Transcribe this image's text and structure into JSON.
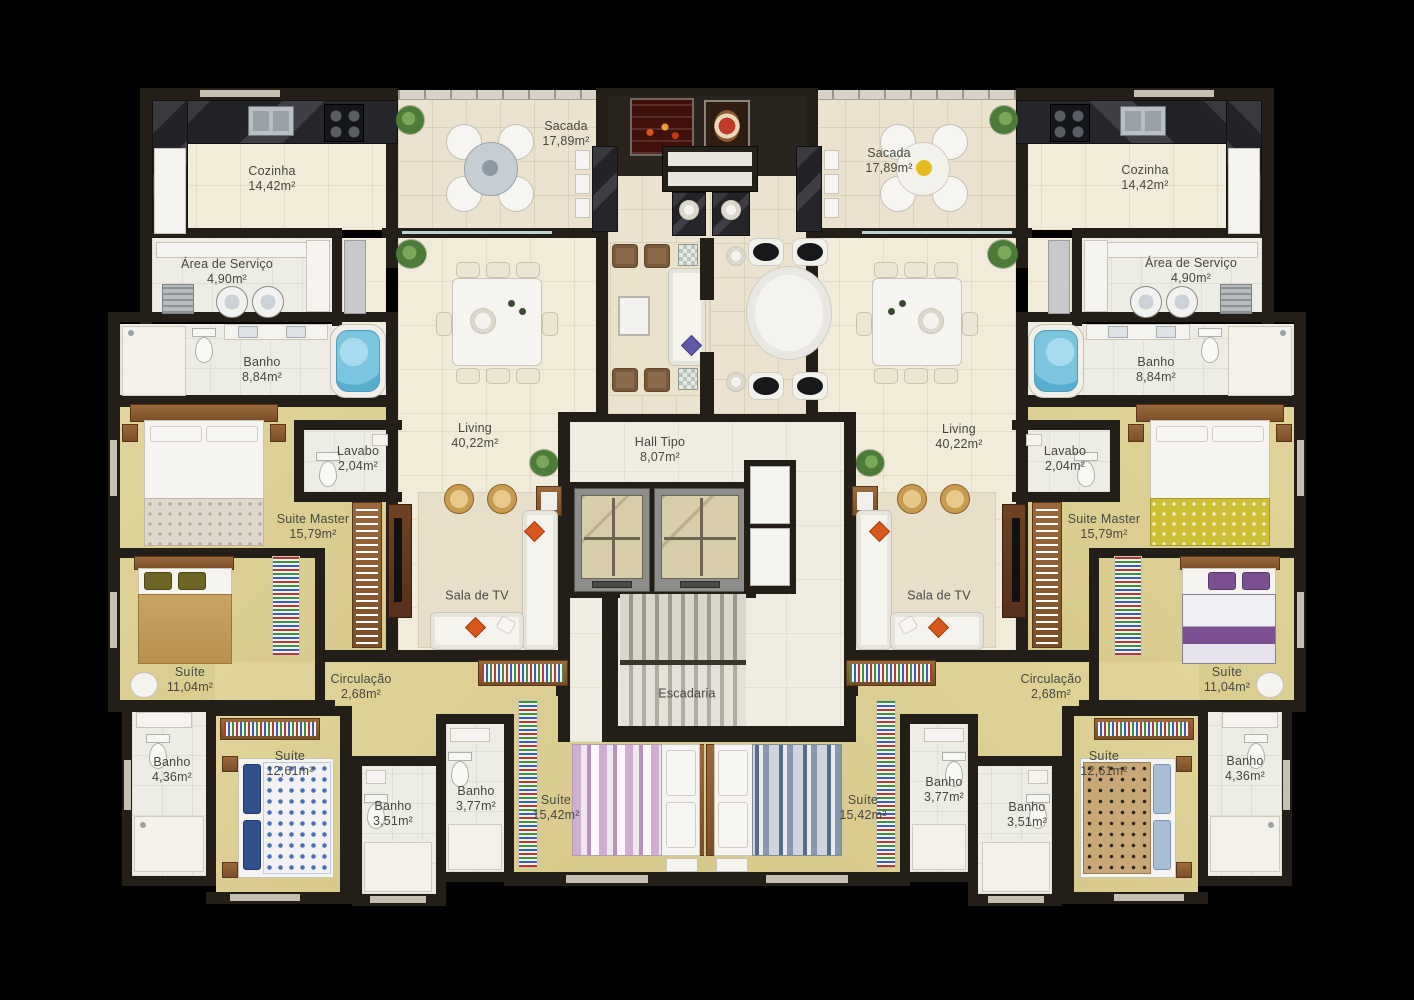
{
  "colors": {
    "background": "#000000",
    "wall": "#231f18",
    "floor_social": "#f1ebd9",
    "floor_balcony": "#ebe3cf",
    "floor_bedroom": "#dccf92",
    "floor_bath": "#edece5",
    "floor_hall": "#efece2",
    "wood": "#8a5a33",
    "counter_marble": "#2f2e33",
    "jacuzzi_water": "#7cc5df",
    "accent_orange": "#d8571e"
  },
  "rooms": [
    {
      "name": "Cozinha",
      "area": "14,42m²"
    },
    {
      "name": "Sacada",
      "area": "17,89m²"
    },
    {
      "name": "Área de Serviço",
      "area": "4,90m²"
    },
    {
      "name": "Banho",
      "area": "8,84m²"
    },
    {
      "name": "Lavabo",
      "area": "2,04m²"
    },
    {
      "name": "Living",
      "area": "40,22m²"
    },
    {
      "name": "Suite Master",
      "area": "15,79m²"
    },
    {
      "name": "Sala de TV",
      "area": ""
    },
    {
      "name": "Suíte",
      "area": "11,04m²"
    },
    {
      "name": "Circulação",
      "area": "2,68m²"
    },
    {
      "name": "Banho",
      "area": "4,36m²"
    },
    {
      "name": "Suíte",
      "area": "12,61m²"
    },
    {
      "name": "Banho",
      "area": "3,51m²"
    },
    {
      "name": "Banho",
      "area": "3,77m²"
    },
    {
      "name": "Suíte",
      "area": "15,42m²"
    },
    {
      "name": "Hall Tipo",
      "area": "8,07m²"
    },
    {
      "name": "Escadaria",
      "area": ""
    },
    {
      "name": "Sacada",
      "area": "17,89m²"
    },
    {
      "name": "Cozinha",
      "area": "14,42m²"
    },
    {
      "name": "Área de Serviço",
      "area": "4,90m²"
    },
    {
      "name": "Banho",
      "area": "8,84m²"
    },
    {
      "name": "Lavabo",
      "area": "2,04m²"
    },
    {
      "name": "Living",
      "area": "40,22m²"
    },
    {
      "name": "Suite Master",
      "area": "15,79m²"
    },
    {
      "name": "Sala de TV",
      "area": ""
    },
    {
      "name": "Suíte",
      "area": "11,04m²"
    },
    {
      "name": "Circulação",
      "area": "2,68m²"
    },
    {
      "name": "Banho",
      "area": "4,36m²"
    },
    {
      "name": "Suíte",
      "area": "12,61m²"
    },
    {
      "name": "Banho",
      "area": "3,51m²"
    },
    {
      "name": "Banho",
      "area": "3,77m²"
    },
    {
      "name": "Suíte",
      "area": "15,42m²"
    }
  ]
}
